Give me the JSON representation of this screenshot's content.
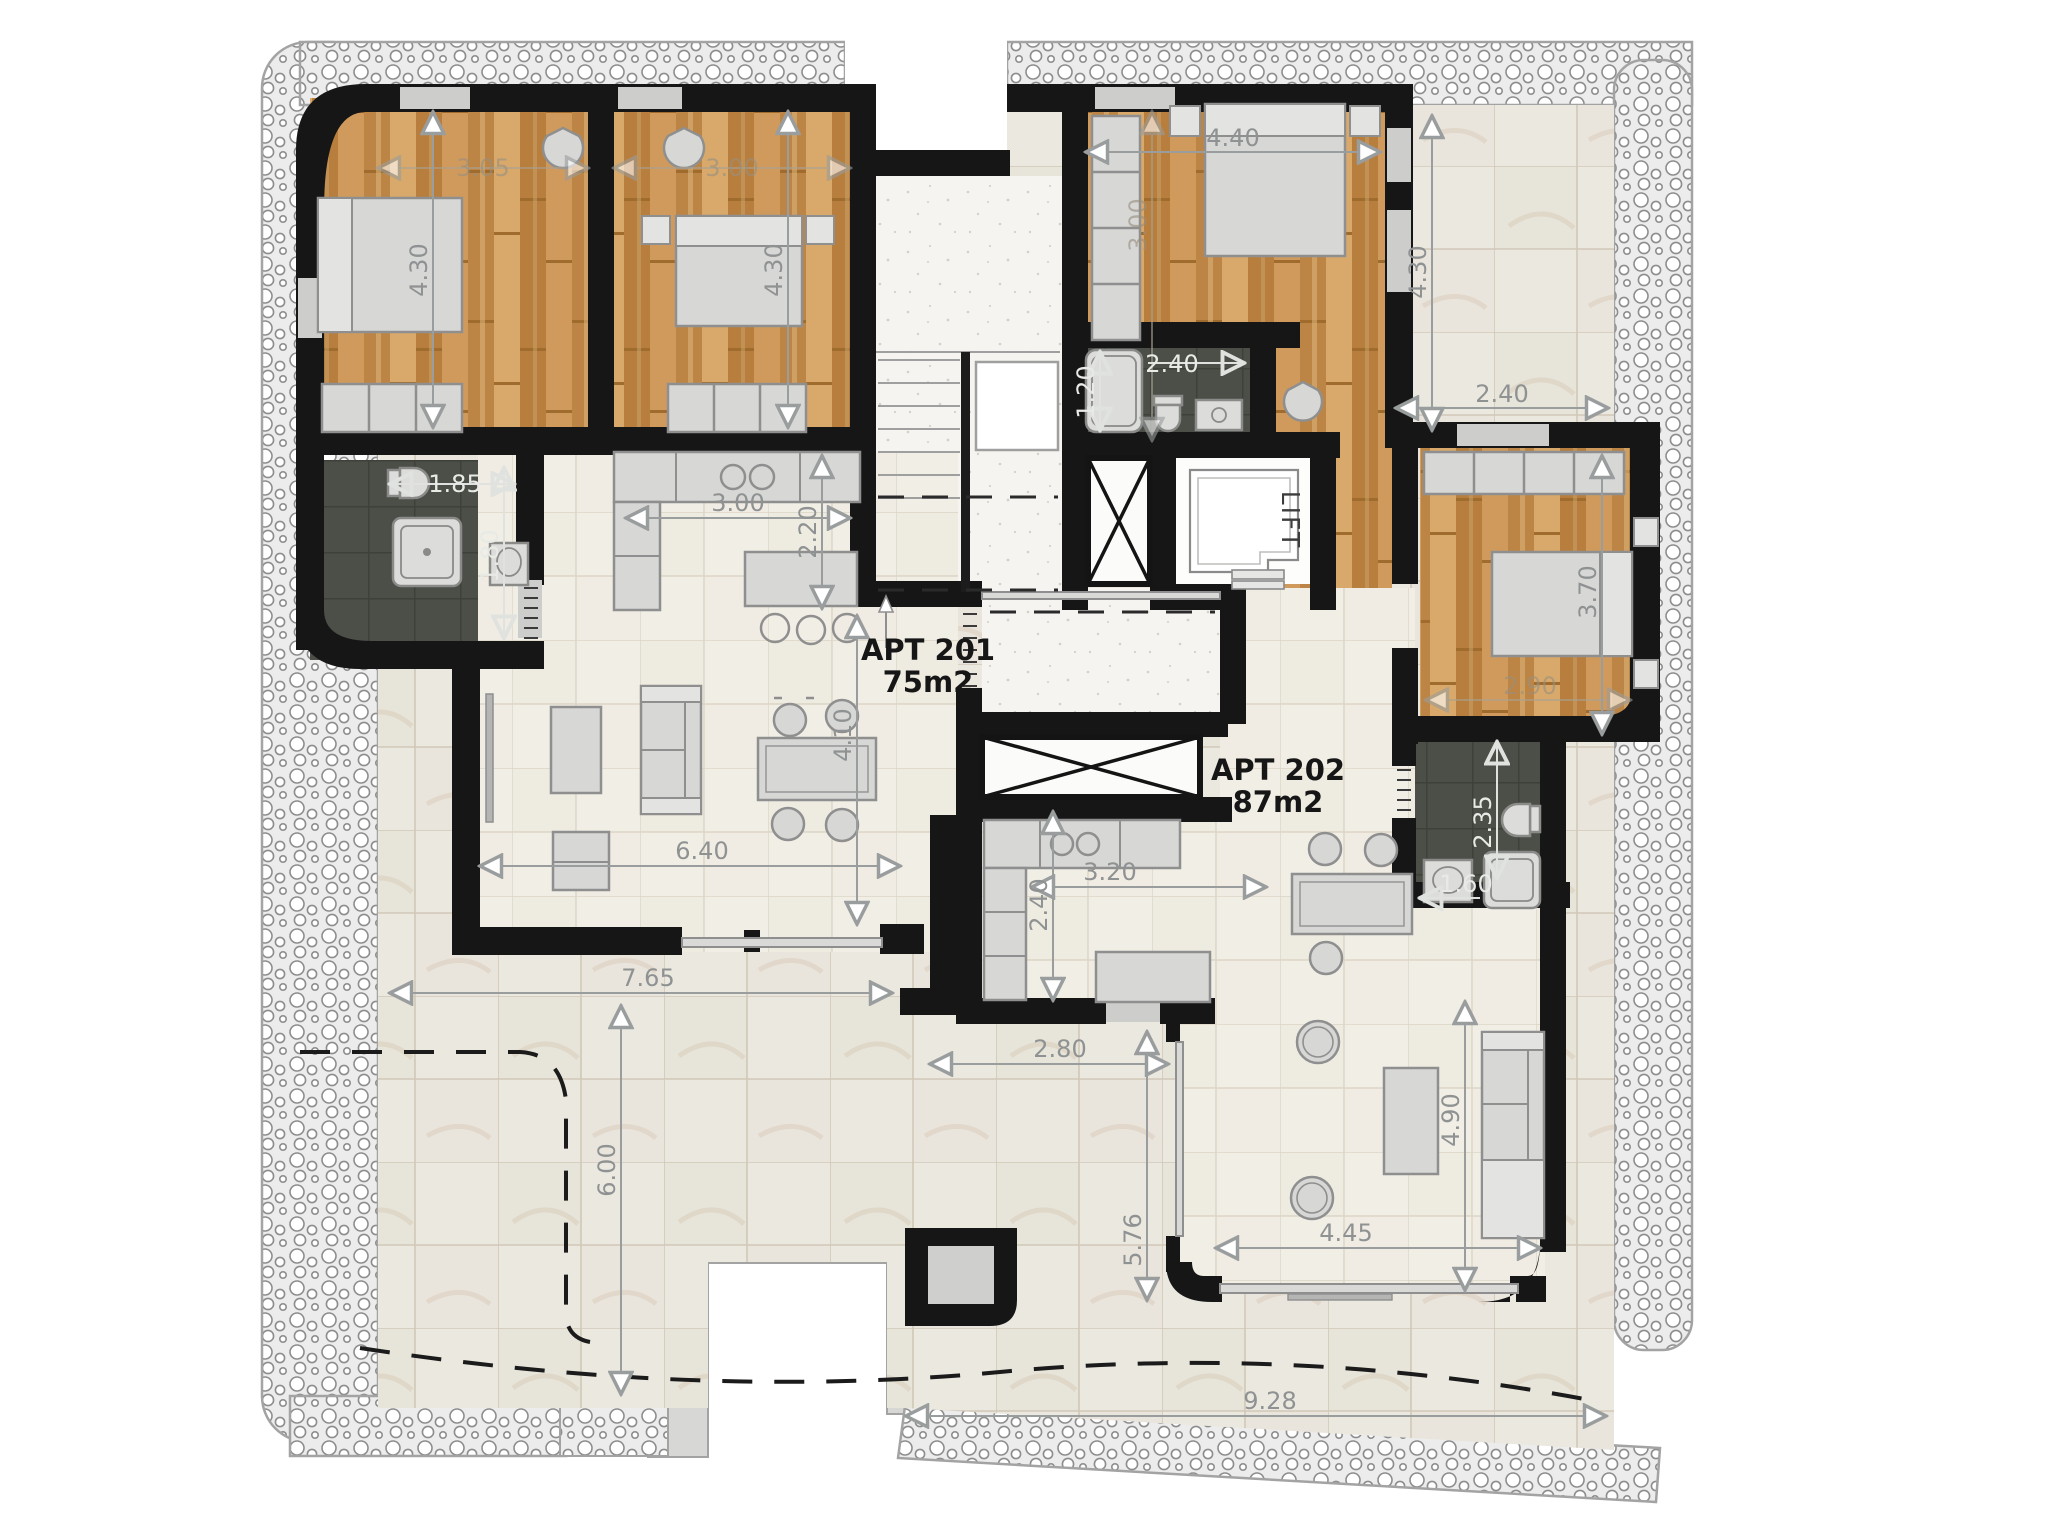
{
  "plan": {
    "apartments": [
      {
        "label": "APT 201",
        "area": "75m2"
      },
      {
        "label": "APT 202",
        "area": "87m2"
      }
    ],
    "lift": "LIFT",
    "dims": {
      "bed1_w": "3.05",
      "bed1_h": "4.30",
      "bed2_w": "3.00",
      "bed2_h": "4.30",
      "mbed_w": "4.40",
      "mbed_h": "3.00",
      "terr_e_h": "4.30",
      "terr_e_w": "2.40",
      "bath2_w": "2.40",
      "bath2_h": "1.20",
      "bath1_w": "1.85",
      "bath1_h": "1.80",
      "kit1_w": "3.00",
      "kit1_d": "2.20",
      "liv1_h": "4.10",
      "liv1_w": "6.40",
      "terr1_w": "7.65",
      "terr1_h": "6.00",
      "kit2_w": "3.20",
      "kit2_d": "2.40",
      "bath3_h": "2.35",
      "bath3_w": "1.60",
      "bed3_h": "3.70",
      "bed3_w": "2.90",
      "terr2_w": "2.80",
      "terr2_h": "5.76",
      "liv2_w": "4.45",
      "liv2_h": "4.90",
      "terr_s_w": "9.28"
    },
    "colors": {
      "wood": "#c48c4d",
      "dark_tile": "#484c45",
      "wall": "#161616",
      "dimension": "#8f9292",
      "terrace_tile": "#ebe8e0"
    }
  }
}
